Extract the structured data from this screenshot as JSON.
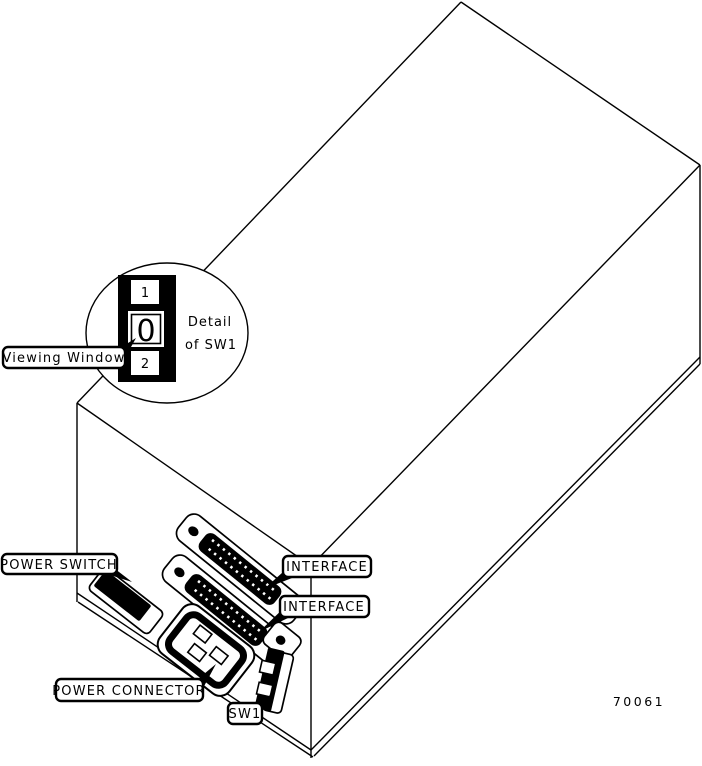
{
  "figure": {
    "number": "70061",
    "background_color": "#ffffff",
    "line_color": "#000000"
  },
  "detail_circle": {
    "caption_line1": "Detail",
    "caption_line2": "of SW1",
    "switch_positions": {
      "top": "1",
      "middle": "0",
      "bottom": "2"
    }
  },
  "callouts": {
    "viewing_window": "Viewing Window",
    "power_switch": "POWER SWITCH",
    "interface_top": "INTERFACE",
    "interface_bottom": "INTERFACE",
    "power_connector": "POWER CONNECTOR",
    "sw1": "SW1"
  }
}
